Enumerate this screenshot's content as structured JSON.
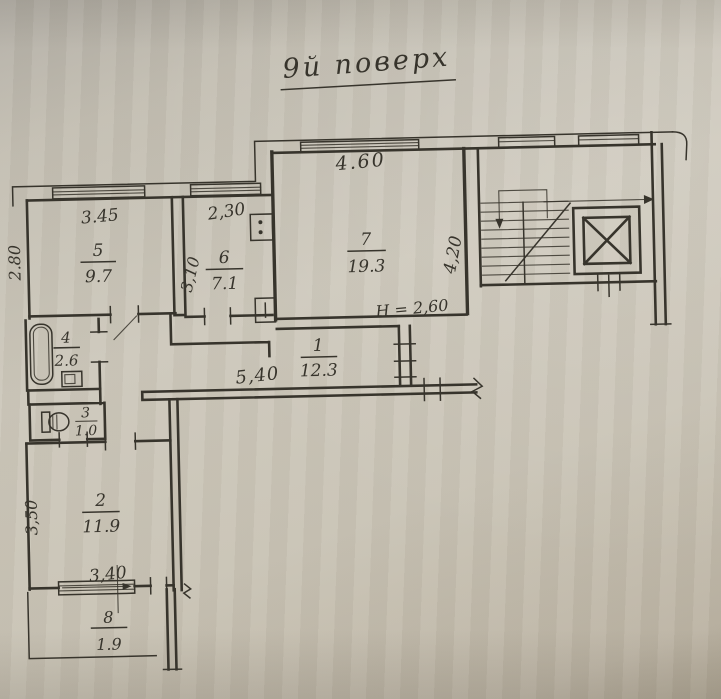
{
  "document": {
    "title": "9й поверх"
  },
  "rooms": [
    {
      "number": "1",
      "area": "12.3"
    },
    {
      "number": "2",
      "area": "11.9"
    },
    {
      "number": "3",
      "area": "1.0"
    },
    {
      "number": "4",
      "area": "2.6"
    },
    {
      "number": "5",
      "area": "9.7"
    },
    {
      "number": "6",
      "area": "7.1"
    },
    {
      "number": "7",
      "area": "19.3"
    },
    {
      "number": "8",
      "area": "1.9"
    }
  ],
  "dimensions": {
    "room5_width": "3.45",
    "room5_depth": "2.80",
    "room6_width": "2,30",
    "room6_depth": "3,10",
    "room7_width": "4.60",
    "room7_depth": "4,20",
    "hall_length": "5,40",
    "room2_width": "3,40",
    "room2_depth": "3,50",
    "ceiling_height": "H = 2,60"
  },
  "colors": {
    "ink": "#37342c",
    "paper": "#c9c4b7"
  }
}
